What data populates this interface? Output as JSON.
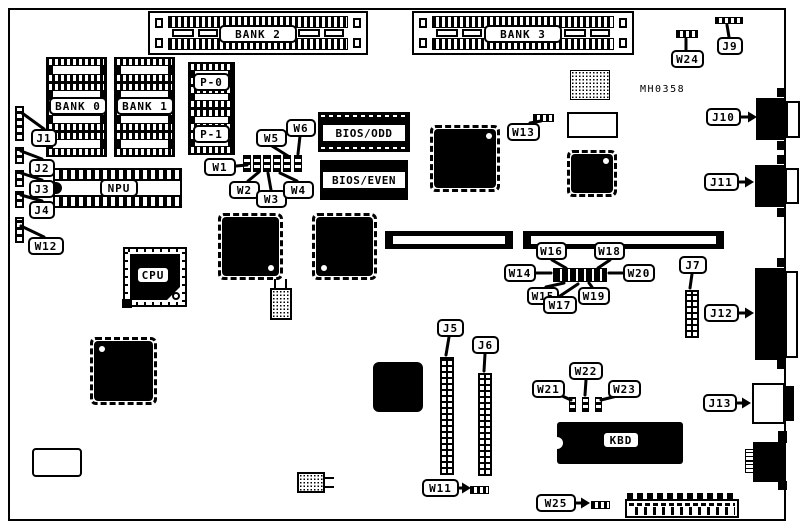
{
  "diagram": {
    "part_number": "MH0358",
    "memory_banks": {
      "bank0": "BANK 0",
      "bank1": "BANK 1",
      "bank2": "BANK 2",
      "bank3": "BANK 3",
      "p0": "P-0",
      "p1": "P-1"
    },
    "chips": {
      "npu": "NPU",
      "cpu": "CPU",
      "kbd": "KBD",
      "bios_odd": "BIOS/ODD",
      "bios_even": "BIOS/EVEN"
    },
    "connectors": {
      "j1": "J1",
      "j2": "J2",
      "j3": "J3",
      "j4": "J4",
      "j5": "J5",
      "j6": "J6",
      "j7": "J7",
      "j9": "J9",
      "j10": "J10",
      "j11": "J11",
      "j12": "J12",
      "j13": "J13"
    },
    "jumpers": {
      "w1": "W1",
      "w2": "W2",
      "w3": "W3",
      "w4": "W4",
      "w5": "W5",
      "w6": "W6",
      "w11": "W11",
      "w12": "W12",
      "w13": "W13",
      "w14": "W14",
      "w15": "W15",
      "w16": "W16",
      "w17": "W17",
      "w18": "W18",
      "w19": "W19",
      "w20": "W20",
      "w21": "W21",
      "w22": "W22",
      "w23": "W23",
      "w24": "W24",
      "w25": "W25"
    }
  }
}
